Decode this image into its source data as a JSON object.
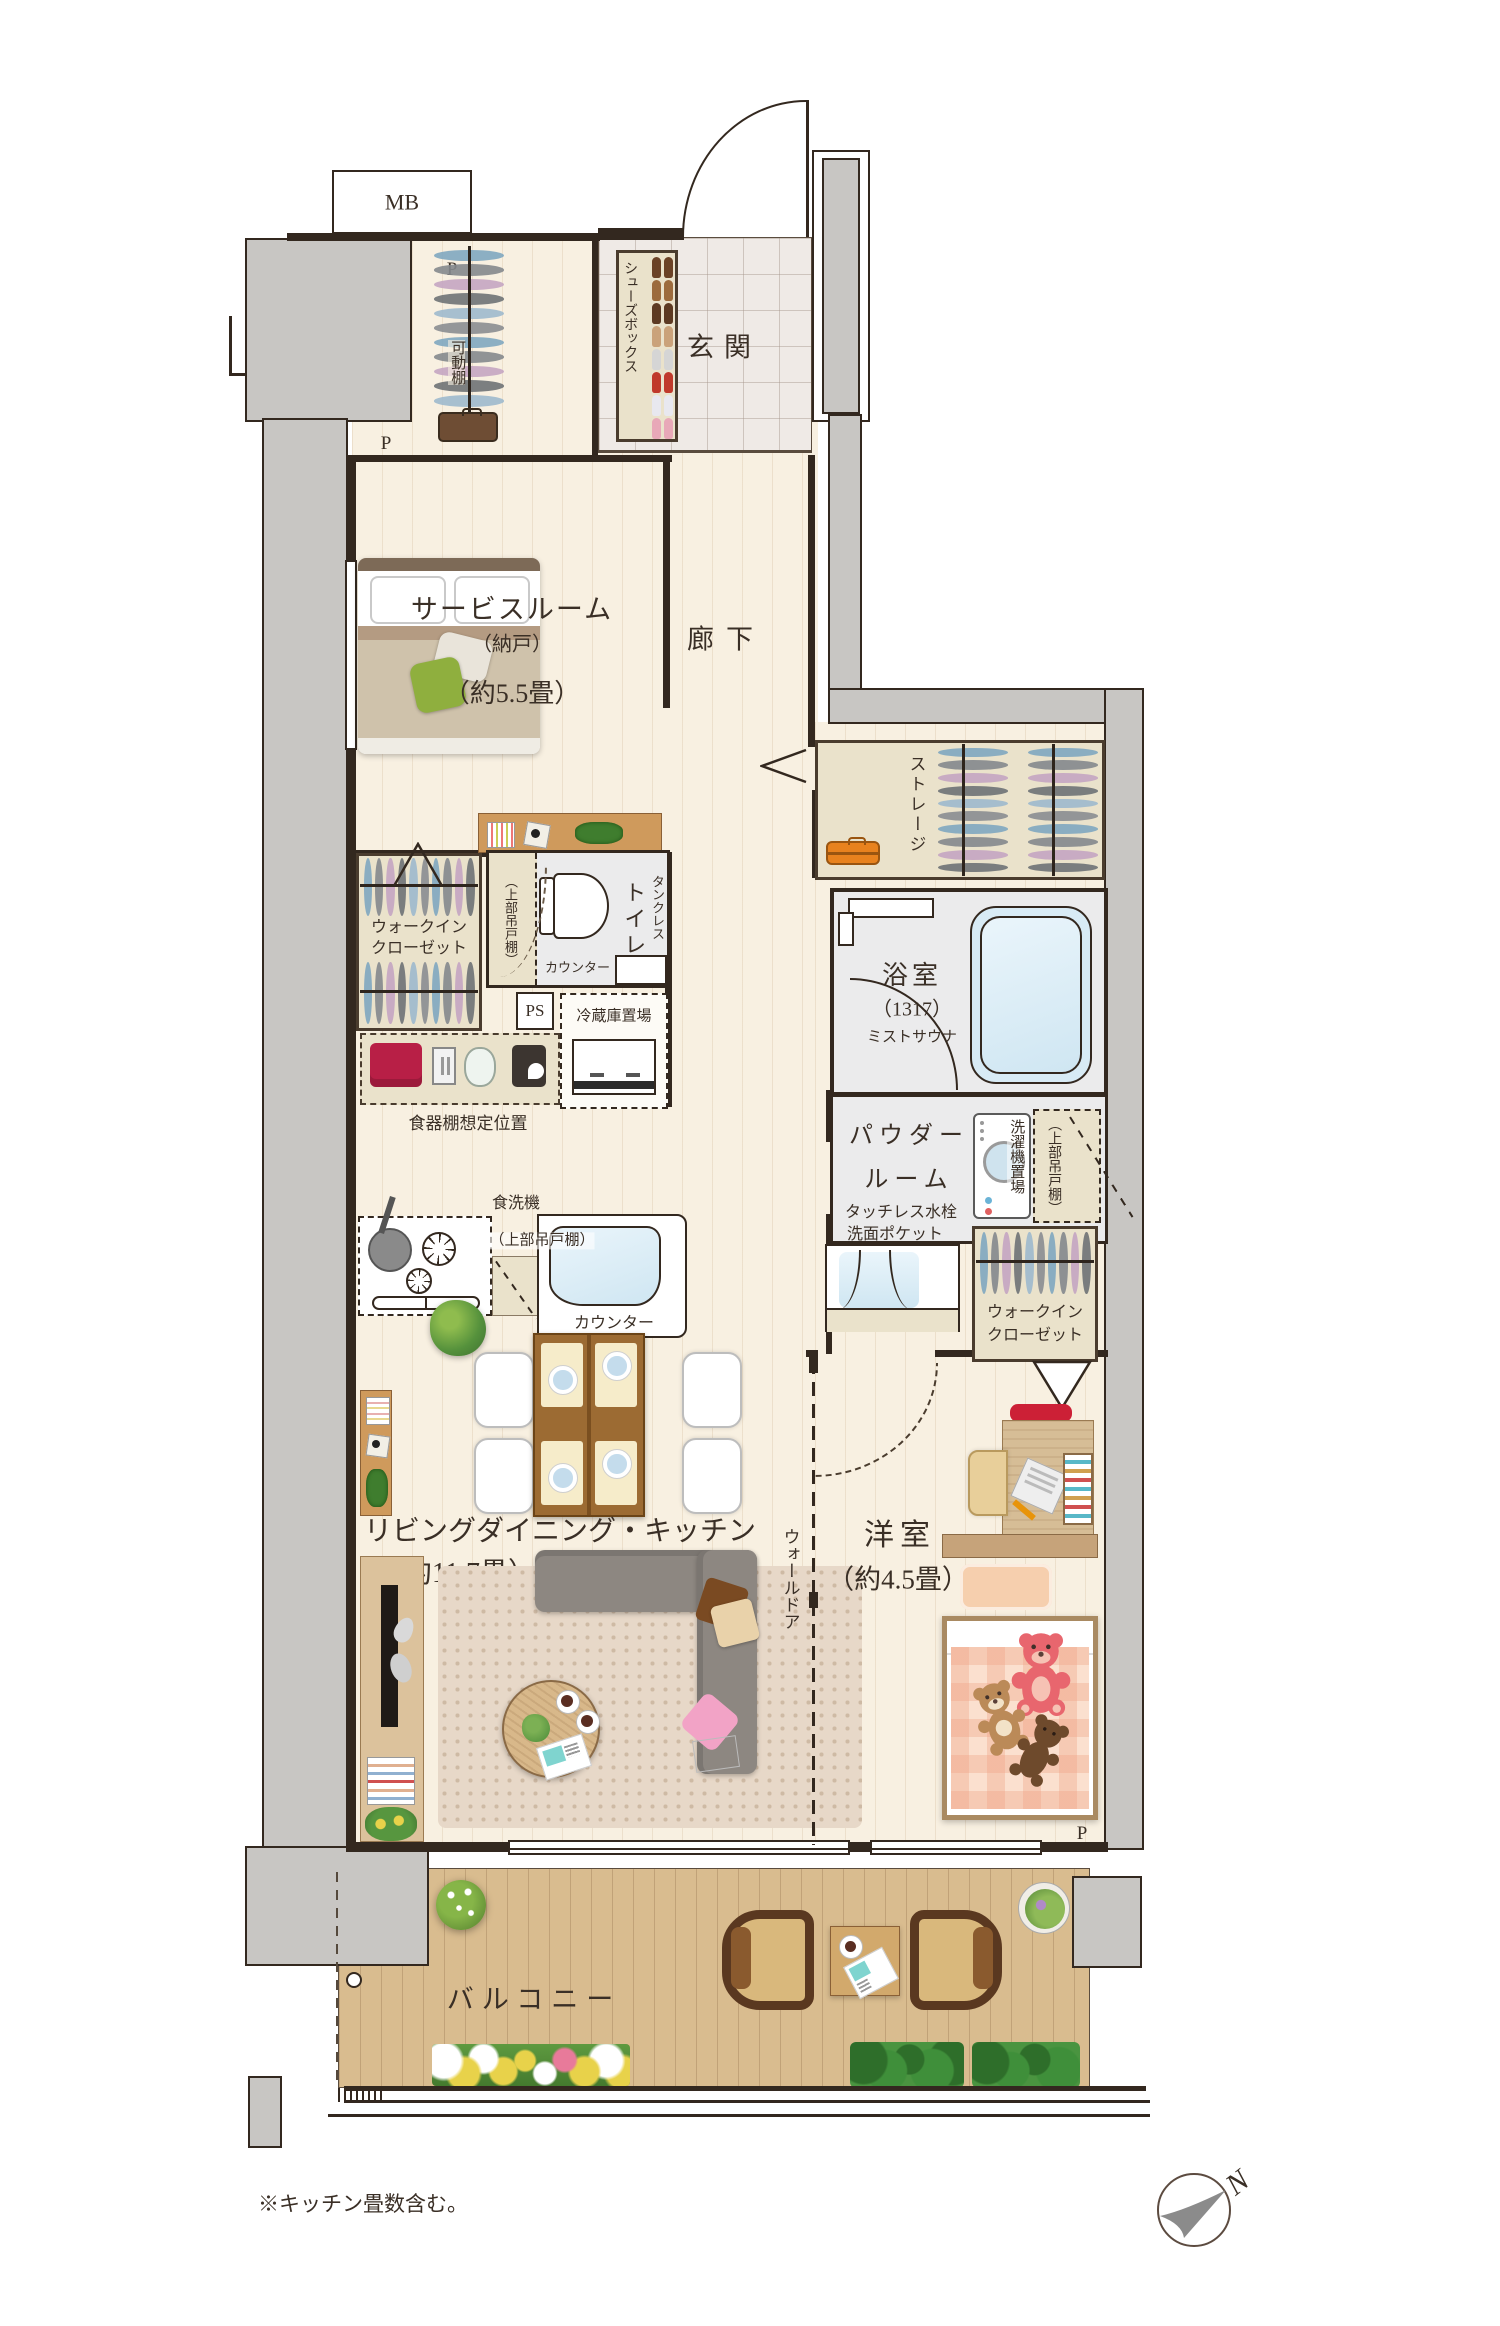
{
  "labels": {
    "mb": "MB",
    "p_closet": "P",
    "p_service": "P",
    "p_bedroom": "P",
    "genkan": "玄関",
    "shoes_box": "シューズボックス",
    "movable_shelf": "可動棚",
    "service_room": {
      "name": "サービスルーム",
      "storage_sub": "（納戸）",
      "size": "（約5.5畳）"
    },
    "corridor": "廊下",
    "storage": "ストレージ",
    "wic1": {
      "line1": "ウォークイン",
      "line2": "クローゼット"
    },
    "toilet": {
      "tankless": "タンクレス",
      "name": "トイレ",
      "upper_shelf": "（上部吊戸棚）",
      "counter": "カウンター"
    },
    "ps": "PS",
    "fridge_space": "冷蔵庫置場",
    "cupboard_note": "食器棚想定位置",
    "bath": {
      "name": "浴室",
      "size": "（1317）",
      "mist": "ミストサウナ"
    },
    "powder": {
      "line1": "パウダー",
      "line2": "ルーム",
      "feature1": "タッチレス水栓",
      "feature2": "洗面ポケット"
    },
    "laundry": {
      "space": "洗濯機置場",
      "upper_shelf": "（上部吊戸棚）"
    },
    "wic2": {
      "line1": "ウォークイン",
      "line2": "クローゼット"
    },
    "kitchen": {
      "dishwasher": "食洗機",
      "upper_shelf": "（上部吊戸棚）",
      "counter": "カウンター"
    },
    "ldk": {
      "name": "リビングダイニング・キッチン",
      "size": "（約11.7畳）※"
    },
    "wall_door": "ウォールドア",
    "western_room": {
      "name": "洋室",
      "size": "（約4.5畳）"
    },
    "balcony": "バルコニー",
    "note": "※キッチン畳数含む。",
    "compass_north": "N"
  },
  "colors": {
    "wall_gray": "#c8c6c3",
    "outline": "#33281f",
    "wood_floor": "#f8f0e1",
    "deck_wood": "#d9bc8f",
    "tile": "#efeae6",
    "closet_beige": "#eae2cb",
    "wet_area": "#ebebec",
    "bath_blue": "#d8ebf5",
    "accent_red": "#c32146"
  }
}
